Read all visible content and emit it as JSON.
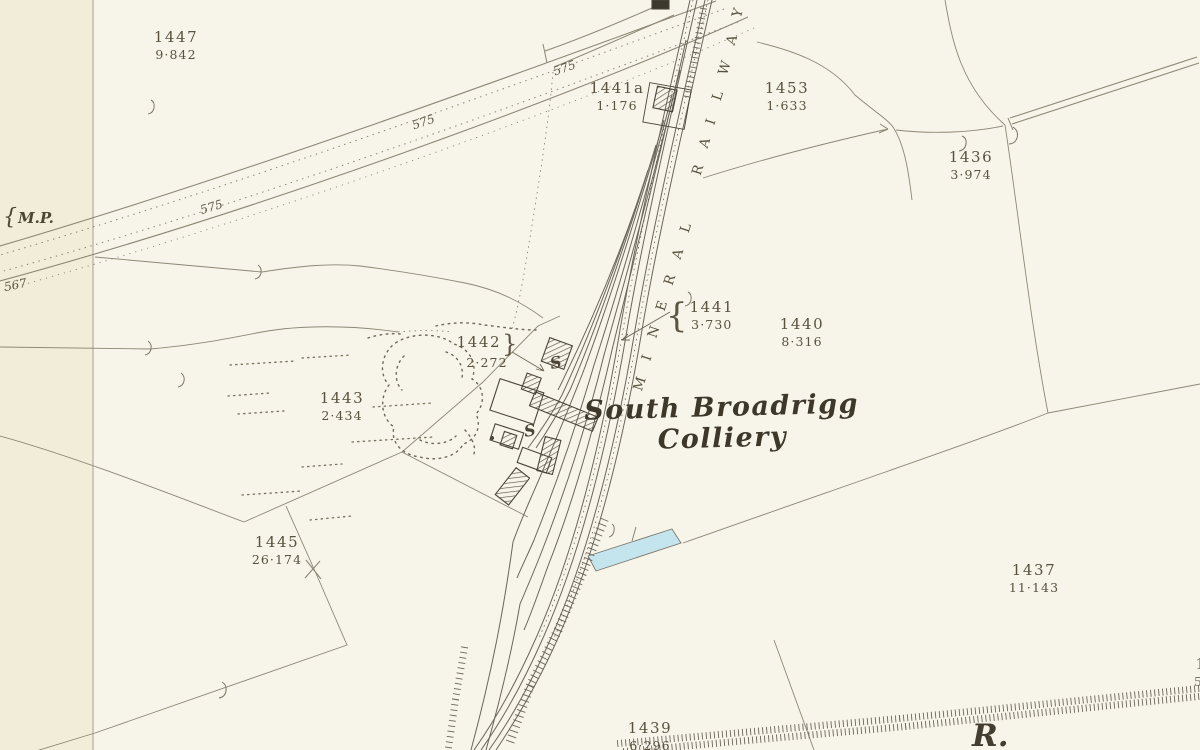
{
  "colors": {
    "paper": "#f7f4ea",
    "margin_strip": "#f2edd9",
    "boundary_line": "#8d8775",
    "railway_line": "#6b665a",
    "building_ink": "#4a4537",
    "water_fill": "#c4e4ee",
    "text_ink": "#59523f"
  },
  "map": {
    "title_label": {
      "line1": "South Broadrigg",
      "line2": "Colliery",
      "x": 722,
      "y": 392
    },
    "railway_label": {
      "text": "MINERAL RAILWAY"
    },
    "river_label": {
      "text": "R.",
      "x": 972,
      "y": 718
    },
    "mile_post": {
      "text": "M.P.",
      "brace": "{",
      "x": 3,
      "y": 205
    },
    "parcels": [
      {
        "number": "1447",
        "area": "9·842",
        "x": 176,
        "y": 30,
        "brace": null
      },
      {
        "number": "1441a",
        "area": "1·176",
        "x": 617,
        "y": 81,
        "brace": null
      },
      {
        "number": "1453",
        "area": "1·633",
        "x": 787,
        "y": 81,
        "brace": null
      },
      {
        "number": "1436",
        "area": "3·974",
        "x": 971,
        "y": 150,
        "brace": null
      },
      {
        "number": "1442",
        "area": "2·272",
        "x": 487,
        "y": 335,
        "brace": "right"
      },
      {
        "number": "1441",
        "area": "3·730",
        "x": 700,
        "y": 300,
        "brace": "left"
      },
      {
        "number": "1440",
        "area": "8·316",
        "x": 802,
        "y": 317,
        "brace": null
      },
      {
        "number": "1443",
        "area": "2·434",
        "x": 342,
        "y": 391,
        "brace": null
      },
      {
        "number": "1445",
        "area": "26·174",
        "x": 277,
        "y": 535,
        "brace": null
      },
      {
        "number": "1437",
        "area": "11·143",
        "x": 1034,
        "y": 563,
        "brace": null
      },
      {
        "number": "1439",
        "area": "6·296",
        "x": 650,
        "y": 721,
        "brace": null
      },
      {
        "number": "1",
        "area": "5·",
        "x": 1201,
        "y": 657,
        "brace": null
      }
    ],
    "spot_heights": [
      {
        "text": "575",
        "x": 553,
        "y": 61,
        "rot": -20
      },
      {
        "text": "575",
        "x": 412,
        "y": 115,
        "rot": -19
      },
      {
        "text": "575",
        "x": 200,
        "y": 200,
        "rot": -17
      },
      {
        "text": "567",
        "x": 4,
        "y": 278,
        "rot": -12
      }
    ],
    "s_marks": [
      {
        "text": "S",
        "x": 550,
        "y": 353,
        "rot": -12
      },
      {
        "text": "S",
        "x": 524,
        "y": 421,
        "rot": -8
      }
    ]
  }
}
